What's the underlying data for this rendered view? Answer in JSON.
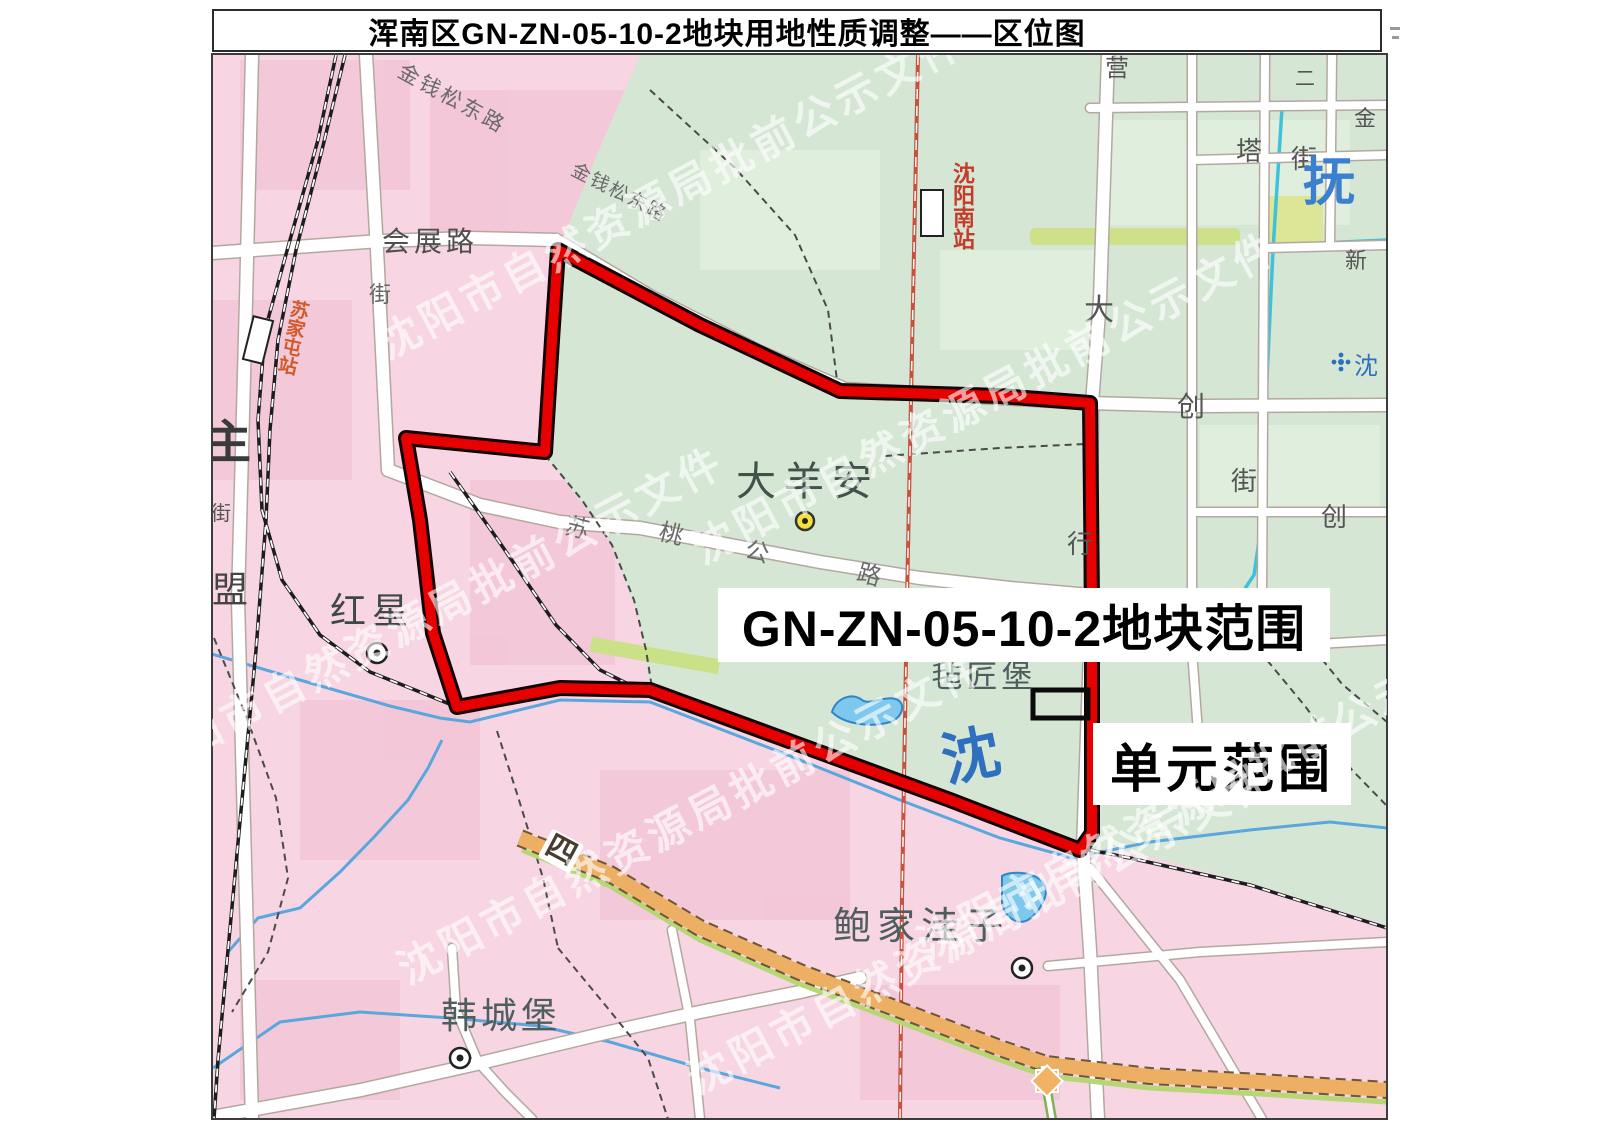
{
  "title": {
    "text": "浑南区GN-ZN-05-10-2地块用地性质调整——区位图"
  },
  "watermark": {
    "text": "沈阳市自然资源局批前公示文件",
    "color": "rgba(255,255,255,0.62)",
    "angle_deg": -28,
    "instances": [
      {
        "x": 670,
        "y": 190
      },
      {
        "x": 430,
        "y": 610
      },
      {
        "x": 985,
        "y": 395
      },
      {
        "x": 690,
        "y": 815
      },
      {
        "x": 1210,
        "y": 790
      },
      {
        "x": 980,
        "y": 925
      }
    ]
  },
  "callouts": {
    "parcel_range": "GN-ZN-05-10-2地块范围",
    "unit_range": "单元范围"
  },
  "colors": {
    "urban_pink": "#f7d5e2",
    "pink_block": "#f2c3d5",
    "green_area": "#d6e6d4",
    "green_block": "#e0eedd",
    "greenway": "#cfe08a",
    "road_white": "#ffffff",
    "road_casing": "#b3a89f",
    "boundary_red": "#e60000",
    "boundary_casing": "#140000",
    "railway_black": "#1d1d1d",
    "hsr_red": "#c8503c",
    "highway_orange": "#ecaf63",
    "stream_blue": "#5aa7dd",
    "canal_cyan": "#3ec2d9",
    "river_text_blue": "#2f6fc0",
    "station_text_red": "#c43b2a"
  },
  "map": {
    "texts": [
      {
        "name": "road-label-huizhanlu",
        "text": "会展路",
        "x": 430,
        "y": 242,
        "size": 28,
        "color": "#4e4e4e",
        "ls": 4
      },
      {
        "name": "road-label-jinqiansongdonglu-1",
        "text": "金钱松东路",
        "x": 452,
        "y": 99,
        "size": 21,
        "color": "#6a6a6a",
        "rot": 29,
        "ls": 3
      },
      {
        "name": "road-label-jinqiansongdonglu-2",
        "text": "金钱松东路",
        "x": 619,
        "y": 193,
        "size": 19,
        "color": "#6a6a6a",
        "rot": 27,
        "ls": 2
      },
      {
        "name": "road-label-jie-a",
        "text": "街",
        "x": 380,
        "y": 295,
        "size": 22,
        "color": "#666666"
      },
      {
        "name": "edge-label-zhu",
        "text": "主",
        "x": 228,
        "y": 442,
        "size": 46,
        "color": "#3a3a3a",
        "bold": true
      },
      {
        "name": "edge-label-jie-b",
        "text": "街",
        "x": 221,
        "y": 514,
        "size": 20,
        "color": "#555555"
      },
      {
        "name": "edge-label-meng",
        "text": "盟",
        "x": 230,
        "y": 590,
        "size": 36,
        "color": "#444444"
      },
      {
        "name": "place-label-hongxing",
        "text": "红星",
        "x": 372,
        "y": 611,
        "size": 36,
        "color": "#3c4747",
        "ls": 6
      },
      {
        "name": "place-label-dayangan",
        "text": "大羊安",
        "x": 808,
        "y": 482,
        "size": 40,
        "color": "#41524a",
        "ls": 8
      },
      {
        "name": "place-label-zhanjiangbu",
        "text": "毡匠堡",
        "x": 984,
        "y": 677,
        "size": 31,
        "color": "#4e5d5d",
        "ls": 4
      },
      {
        "name": "place-label-baojiawazi",
        "text": "鲍家洼子",
        "x": 921,
        "y": 927,
        "size": 38,
        "color": "#4e5d5d",
        "ls": 6
      },
      {
        "name": "place-label-hanchengbu",
        "text": "韩城堡",
        "x": 501,
        "y": 1016,
        "size": 36,
        "color": "#4e5d5d",
        "ls": 4
      },
      {
        "name": "road-char-su",
        "text": "苏",
        "x": 577,
        "y": 529,
        "size": 24,
        "color": "#6a6a6a",
        "rot": 14
      },
      {
        "name": "road-char-tao",
        "text": "桃",
        "x": 671,
        "y": 535,
        "size": 24,
        "color": "#6a6a6a",
        "rot": 14
      },
      {
        "name": "road-char-gong",
        "text": "公",
        "x": 757,
        "y": 553,
        "size": 24,
        "color": "#6a6a6a",
        "rot": 14
      },
      {
        "name": "road-char-lu",
        "text": "路",
        "x": 869,
        "y": 576,
        "size": 24,
        "color": "#6a6a6a",
        "rot": 16
      },
      {
        "name": "road-char-da",
        "text": "大",
        "x": 1099,
        "y": 311,
        "size": 30,
        "color": "#555555"
      },
      {
        "name": "road-char-xing",
        "text": "行",
        "x": 1080,
        "y": 544,
        "size": 26,
        "color": "#555555"
      },
      {
        "name": "road-char-chuang-1",
        "text": "创",
        "x": 1191,
        "y": 407,
        "size": 28,
        "color": "#555555"
      },
      {
        "name": "road-char-jie-1",
        "text": "街",
        "x": 1244,
        "y": 481,
        "size": 26,
        "color": "#555555"
      },
      {
        "name": "road-char-chuang-2",
        "text": "创",
        "x": 1334,
        "y": 517,
        "size": 26,
        "color": "#555555"
      },
      {
        "name": "road-char-ta",
        "text": "塔",
        "x": 1249,
        "y": 151,
        "size": 26,
        "color": "#555555"
      },
      {
        "name": "road-char-jie-2",
        "text": "街",
        "x": 1304,
        "y": 159,
        "size": 26,
        "color": "#555555"
      },
      {
        "name": "road-char-ying",
        "text": "营",
        "x": 1117,
        "y": 69,
        "size": 24,
        "color": "#555555"
      },
      {
        "name": "road-char-er",
        "text": "二",
        "x": 1305,
        "y": 79,
        "size": 20,
        "color": "#555555"
      },
      {
        "name": "road-char-jin",
        "text": "金",
        "x": 1365,
        "y": 119,
        "size": 22,
        "color": "#555555"
      },
      {
        "name": "road-char-xin",
        "text": "新",
        "x": 1356,
        "y": 261,
        "size": 22,
        "color": "#555555"
      },
      {
        "name": "river-label-fu",
        "text": "抚",
        "x": 1329,
        "y": 184,
        "size": 52,
        "color": "#3a7fd0",
        "bold": true,
        "serif": true
      },
      {
        "name": "river-label-shen-big",
        "text": "沈",
        "x": 971,
        "y": 757,
        "size": 58,
        "color": "#2f6fc0",
        "bold": true,
        "serif": true,
        "rot": -12
      },
      {
        "name": "poi-label-shen-small",
        "text": "沈",
        "x": 1366,
        "y": 367,
        "size": 24,
        "color": "#2f6fc0",
        "serif": true
      },
      {
        "name": "highway-shield-si",
        "text": "四",
        "x": 561,
        "y": 851,
        "size": 30,
        "color": "#4a3d30",
        "rot": 28,
        "bold": true,
        "bg": "#ffffff"
      },
      {
        "name": "station-label-shenyangnan",
        "text": "沈阳南站",
        "x": 962,
        "y": 206,
        "size": 22,
        "color": "#c43b2a",
        "vert": true,
        "bold": true
      },
      {
        "name": "station-label-sujiatun",
        "text": "苏家屯站",
        "x": 292,
        "y": 337,
        "size": 19,
        "color": "#d05a2a",
        "vert": true,
        "bold": true,
        "rot": 12
      }
    ]
  }
}
